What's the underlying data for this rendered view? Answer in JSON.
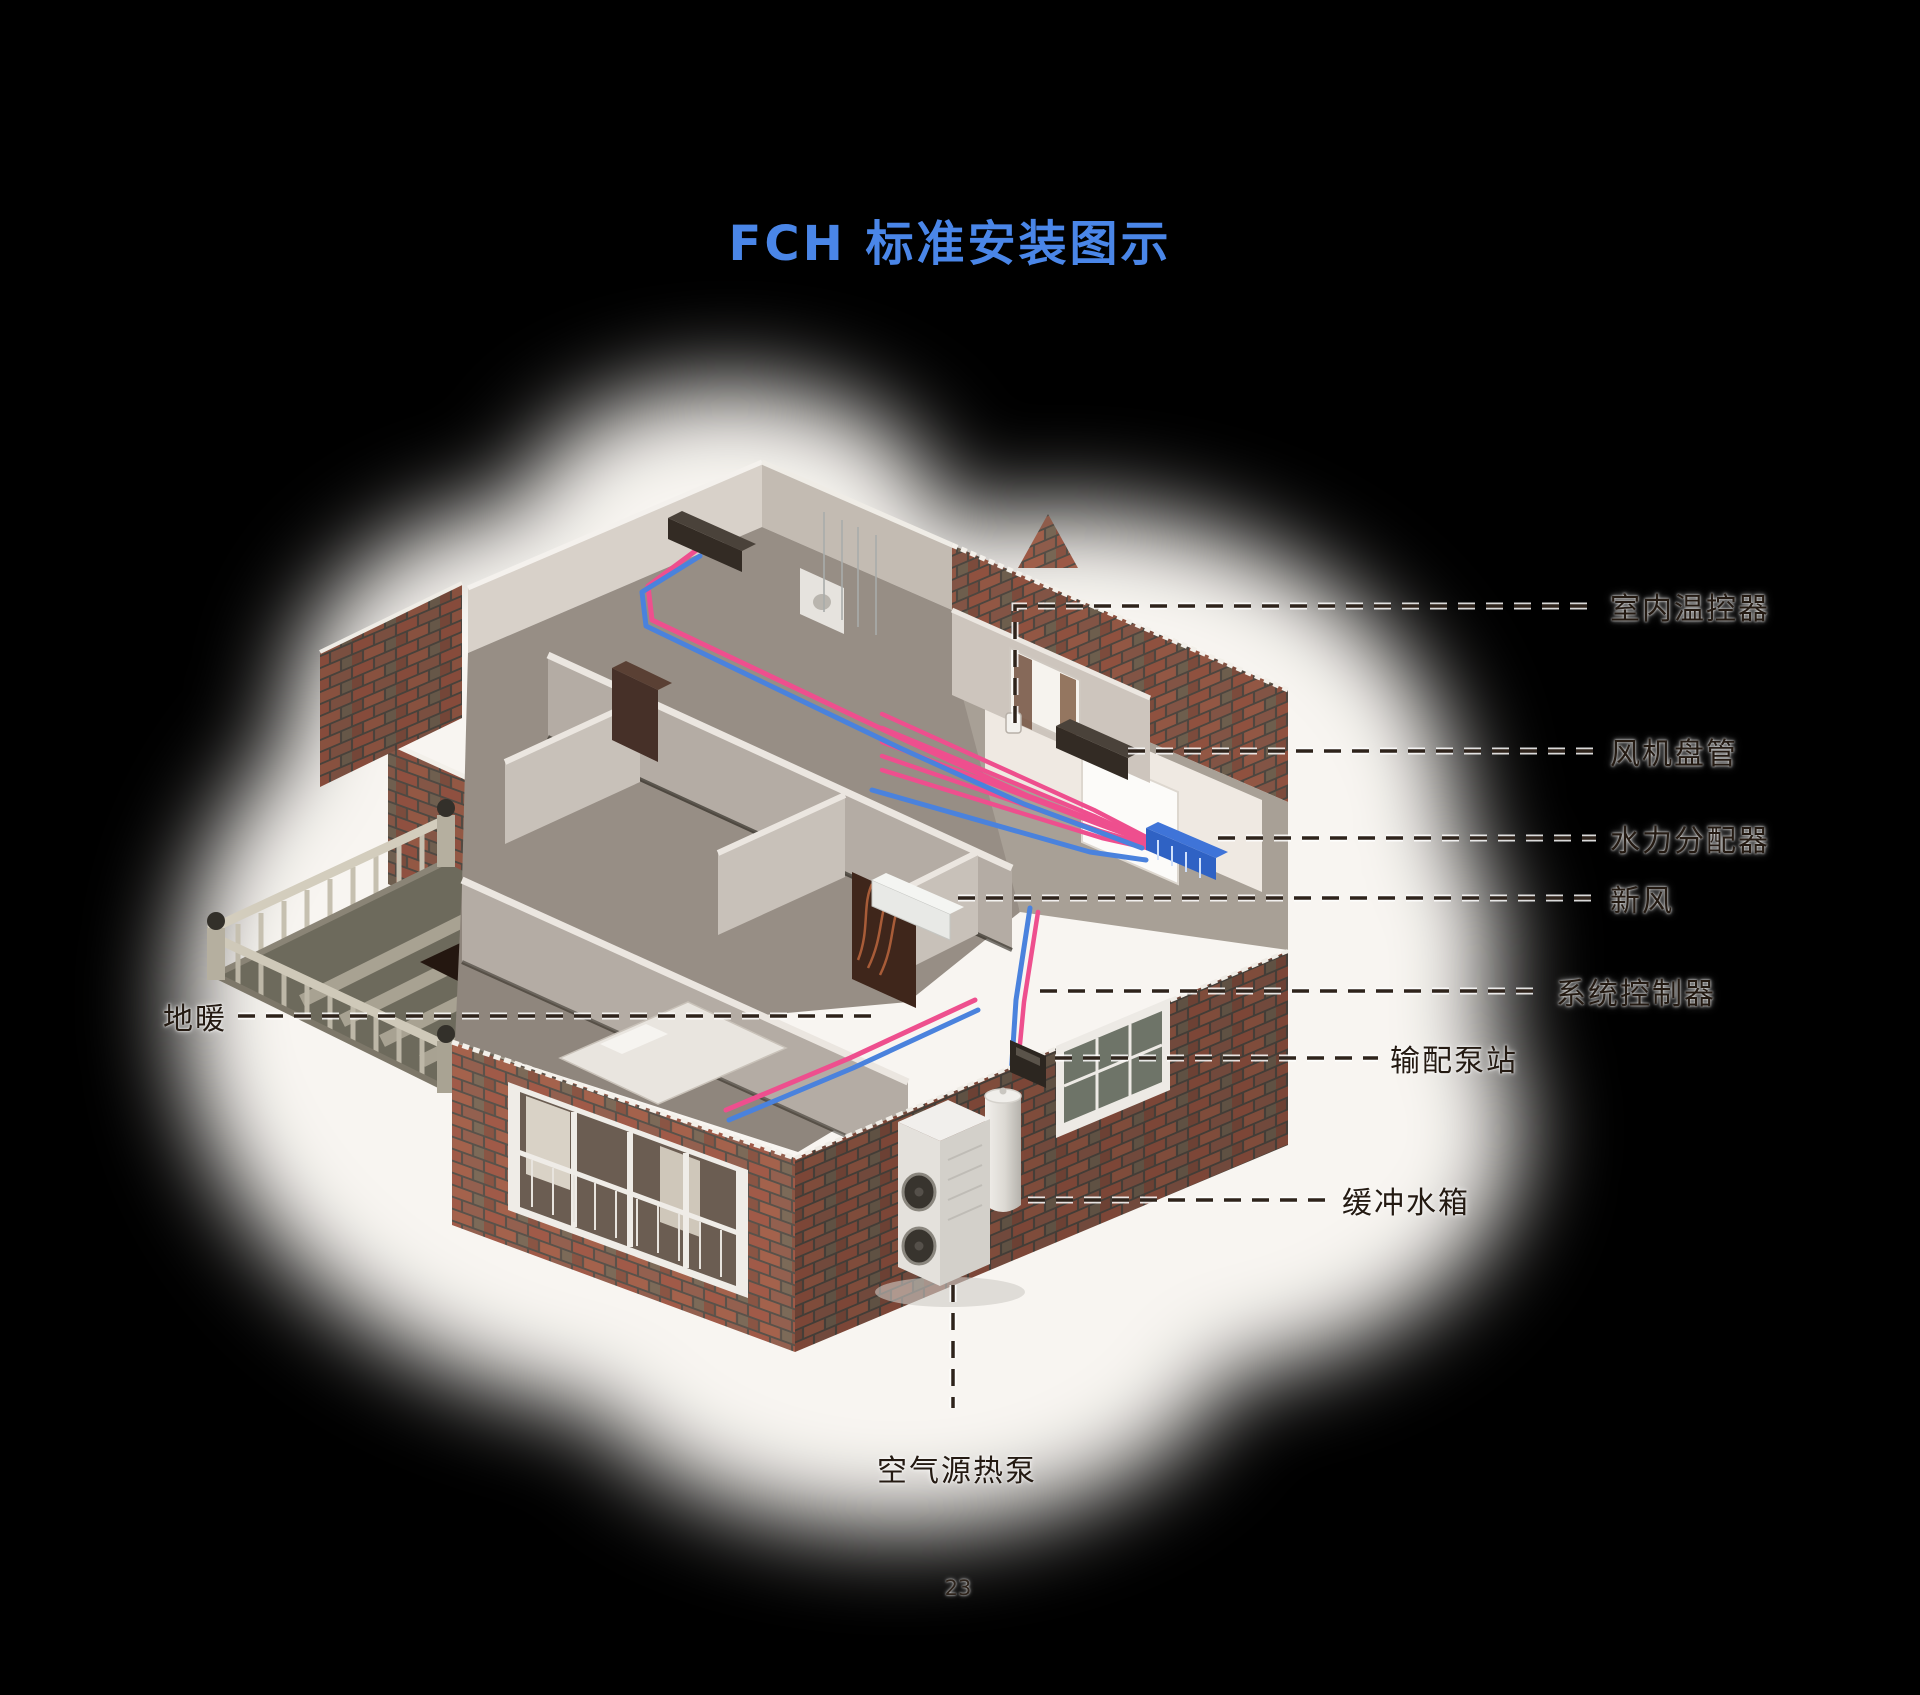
{
  "title": {
    "text": "FCH 标准安装图示"
  },
  "page_number": "23",
  "labels": {
    "indoor_thermostat": "室内温控器",
    "fan_coil": "风机盘管",
    "hydraulic_distributor": "水力分配器",
    "fresh_air": "新风",
    "system_controller": "系统控制器",
    "distribution_pump_station": "输配泵站",
    "buffer_tank": "缓冲水箱",
    "air_source_heat_pump": "空气源热泵",
    "floor_heating": "地暖"
  },
  "colors": {
    "title_blue": "#4a86e8",
    "label_text": "#241a12",
    "pipe_hot": "#ee4f8e",
    "pipe_cold": "#4a82dd",
    "brick": "#a05a48",
    "background": "#000000"
  }
}
